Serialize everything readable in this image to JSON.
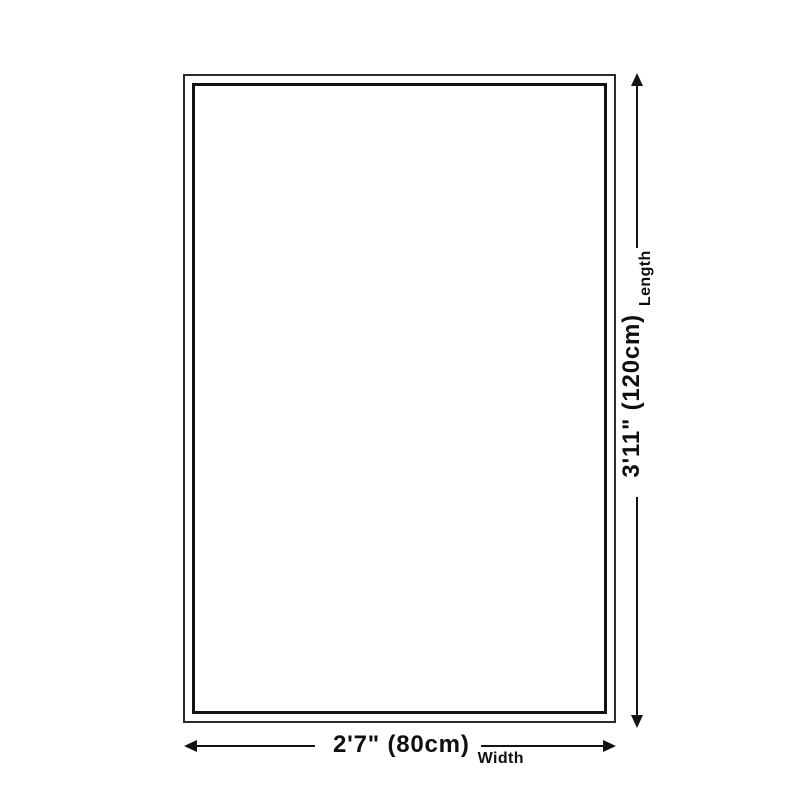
{
  "page": {
    "background_color": "#ffffff",
    "line_color": "#141414",
    "text_color": "#0f0f0f"
  },
  "diagram": {
    "outline": {
      "shape": "rectangle-double-border",
      "border_color": "#121212",
      "fill_color": "#ffffff"
    },
    "length": {
      "value": "3'11\" (120cm)",
      "label": "Length"
    },
    "width": {
      "value": "2'7\" (80cm)",
      "label": "Width"
    }
  }
}
